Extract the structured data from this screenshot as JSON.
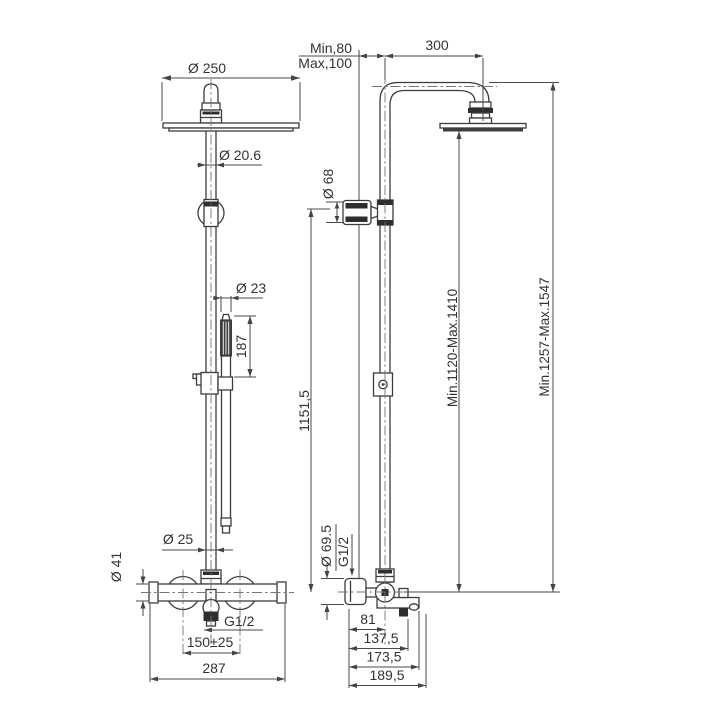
{
  "drawing": {
    "front": {
      "dim_head_diameter": "Ø 250",
      "dim_pipe_diameter": "Ø 20.6",
      "dim_handshower_diameter": "Ø 23",
      "dim_handshower_length": "187",
      "dim_riser_diameter": "Ø 25",
      "dim_body_diameter": "Ø 41",
      "dim_outlet_thread": "G1/2",
      "dim_inlet_spacing": "150±25",
      "dim_overall_width": "287"
    },
    "side": {
      "dim_wall_min": "Min,80",
      "dim_wall_max": "Max,100",
      "dim_arm_reach": "300",
      "dim_handshower_head_diameter": "Ø 68",
      "dim_column_height": "1151,5",
      "dim_head_height_range": "Min.1120-Max.1410",
      "dim_total_height_range": "Min.1257-Max.1547",
      "dim_handle_diameter": "Ø 69.5",
      "dim_connection_thread": "G1/2",
      "dim_depth_riser": "81",
      "dim_depth_mid": "137,5",
      "dim_depth_body": "173,5",
      "dim_depth_overall": "189,5"
    }
  }
}
